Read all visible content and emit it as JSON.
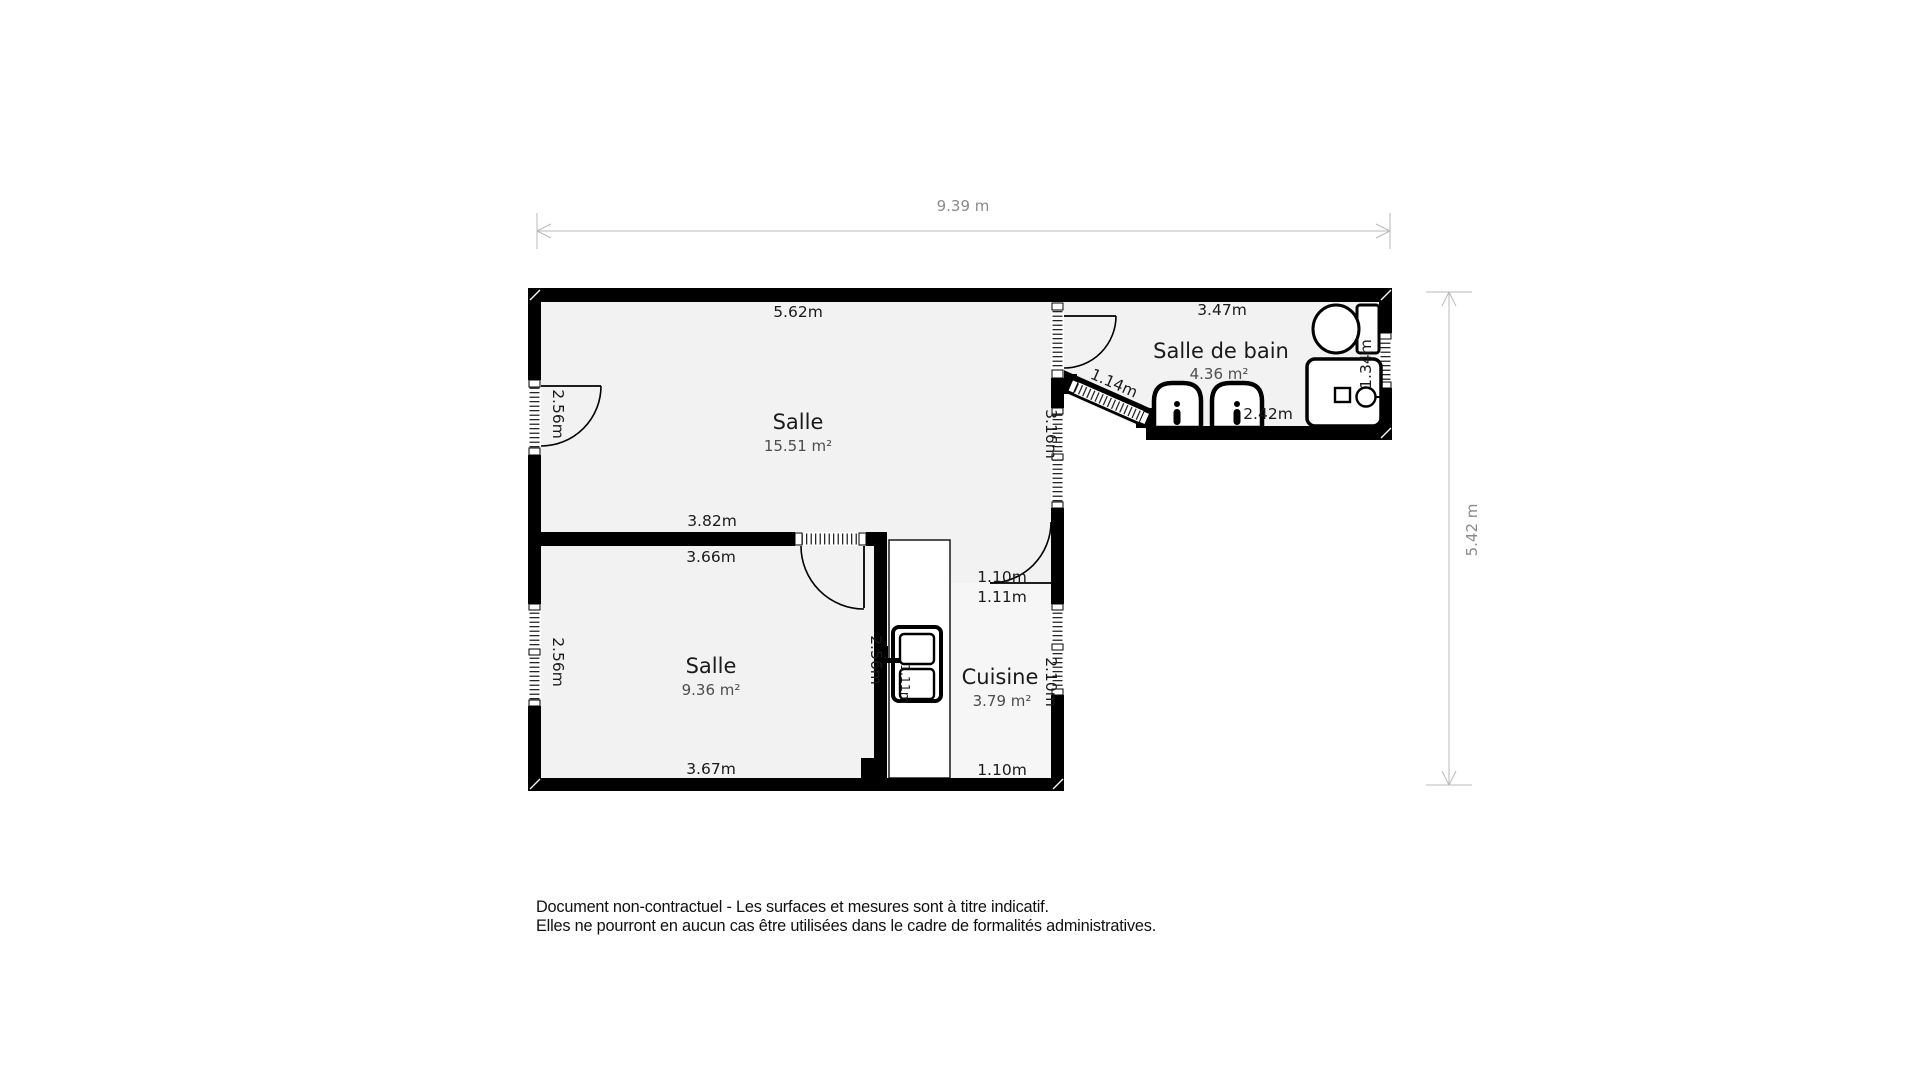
{
  "dimensions": {
    "width": "9.39 m",
    "height": "5.42 m"
  },
  "rooms": {
    "salle_principale": {
      "name": "Salle",
      "area": "15.51 m²",
      "measurements": {
        "top": "5.62m",
        "left": "2.56m",
        "right": "3.16m"
      }
    },
    "salle_secondaire": {
      "name": "Salle",
      "area": "9.36 m²",
      "measurements": {
        "wall_top_upper": "3.82m",
        "wall_top_lower": "3.66m",
        "left": "2.56m",
        "right": "2.56m",
        "bottom": "3.67m"
      }
    },
    "cuisine": {
      "name": "Cuisine",
      "area": "3.79 m²",
      "measurements": {
        "door_width": "1.10m",
        "door_clearance": "1.11m",
        "right": "2.10m",
        "bottom": "1.10m",
        "closet_width": "1.11m"
      }
    },
    "salle_de_bain": {
      "name": "Salle de bain",
      "area": "4.36 m²",
      "measurements": {
        "top": "3.47m",
        "entry_diagonal": "1.14m",
        "bottom": "2.42m",
        "right": "1.34m"
      }
    }
  },
  "disclaimer": {
    "line1": "Document non-contractuel - Les surfaces et mesures sont à titre indicatif.",
    "line2": "Elles ne pourront en aucun cas être utilisées dans le cadre de formalités administratives."
  },
  "colors": {
    "wall": "#000000",
    "floor": "#f2f2f2",
    "floor_kitchen": "#f6f6f6",
    "dimension_line": "#b9b9b9",
    "dimension_text": "#8a8a8a",
    "label_text": "#1a1a1a",
    "area_text": "#4d4d4d",
    "background": "#ffffff"
  }
}
